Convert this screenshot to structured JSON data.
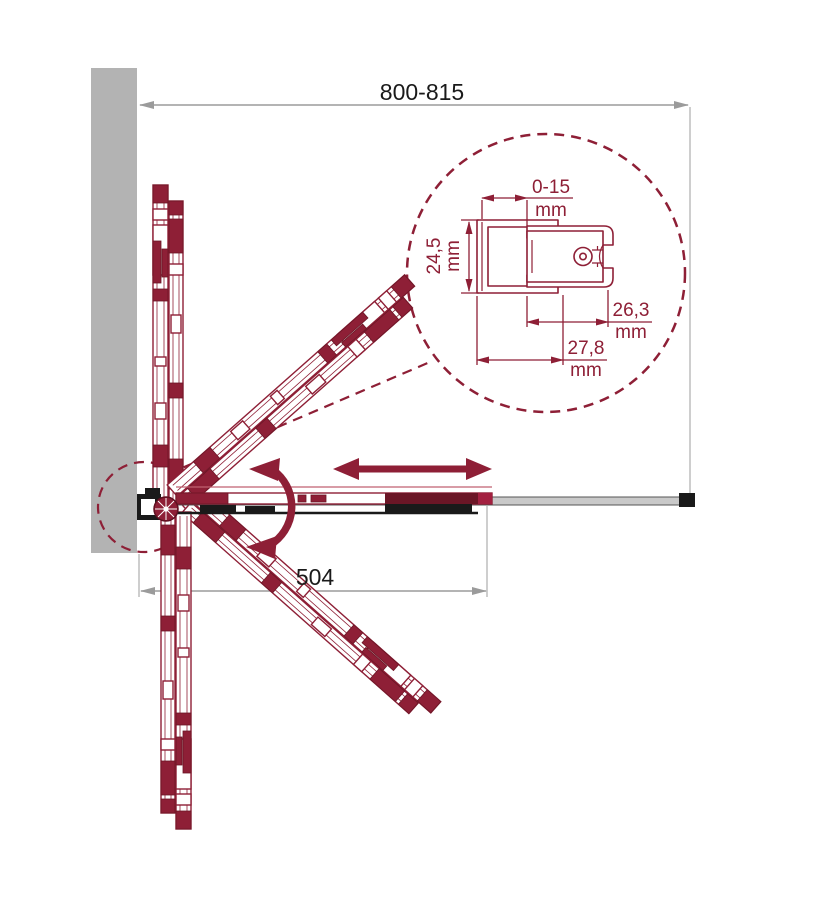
{
  "drawing": {
    "title": "folding-shower-door-plan-view",
    "dimensions": {
      "overall_width_label": "800-815",
      "opening_width_label": "504"
    },
    "detail_view": {
      "adjustment_range_value": "0-15",
      "adjustment_range_unit": "mm",
      "profile_height_value": "24,5",
      "profile_height_unit": "mm",
      "inner_depth_value": "26,3",
      "inner_depth_unit": "mm",
      "outer_depth_value": "27,8",
      "outer_depth_unit": "mm"
    },
    "icons": {
      "rotation_arrow": "rotation-arrow-icon",
      "slide_arrow": "slide-arrow-icon"
    },
    "colors": {
      "accent": "#8E1F36",
      "accent_dark": "#6B1626",
      "wall_gray": "#B3B3B3",
      "dimension_gray": "#9B9B9B",
      "text_black": "#1A1A1A",
      "hardware_black": "#1A1A1A",
      "rail_gray": "#C9C9C9"
    }
  }
}
